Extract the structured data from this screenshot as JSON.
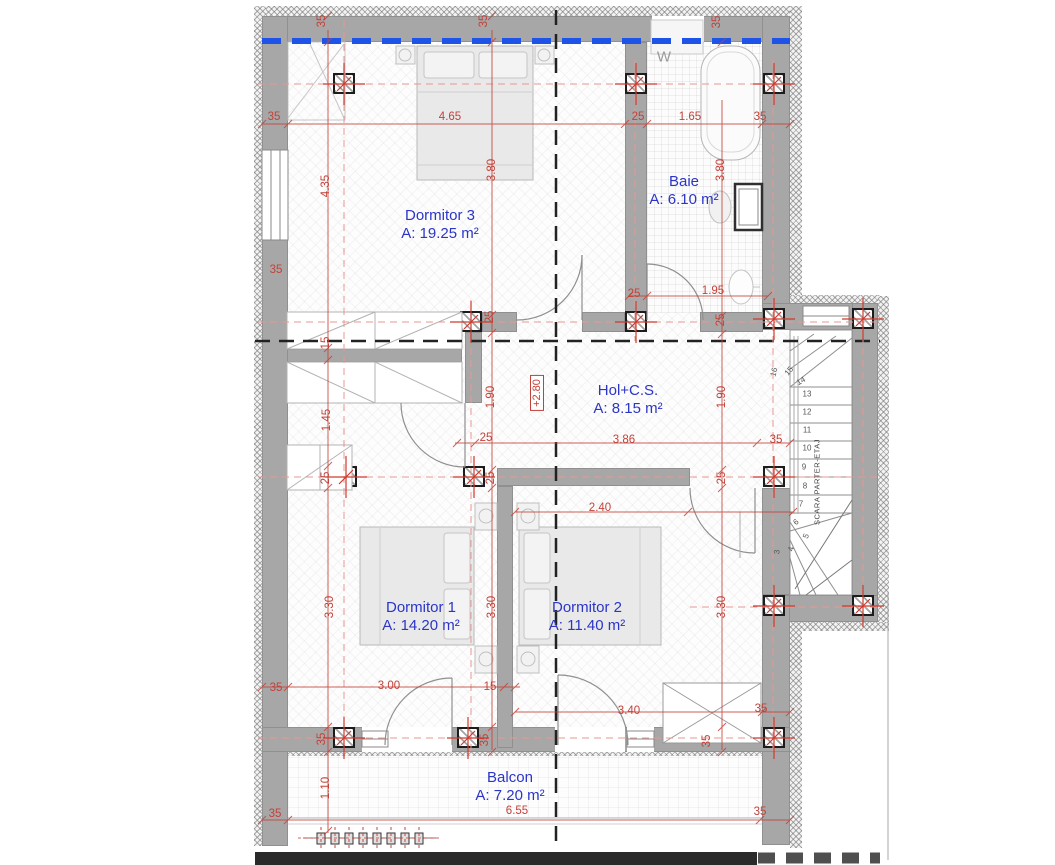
{
  "plan": {
    "type": "floor-plan",
    "colors": {
      "dimension_red": "#c2423a",
      "room_label_blue": "#2b35c8",
      "wall_gray": "#a7a7a7",
      "section_line_blue": "#1d53e6",
      "axis_pink": "#e59991"
    },
    "rooms": [
      {
        "id": "dormitor3",
        "name": "Dormitor 3",
        "area": "A: 19.25 m²",
        "x": 440,
        "y": 225
      },
      {
        "id": "baie",
        "name": "Baie",
        "area": "A: 6.10 m²",
        "x": 684,
        "y": 191
      },
      {
        "id": "hol",
        "name": "Hol+C.S.",
        "area": "A: 8.15 m²",
        "x": 628,
        "y": 400
      },
      {
        "id": "dormitor1",
        "name": "Dormitor 1",
        "area": "A: 14.20 m²",
        "x": 421,
        "y": 617
      },
      {
        "id": "dormitor2",
        "name": "Dormitor 2",
        "area": "A: 11.40 m²",
        "x": 587,
        "y": 617
      },
      {
        "id": "balcon",
        "name": "Balcon",
        "area": "A: 7.20 m²",
        "x": 510,
        "y": 787
      }
    ],
    "labels": {
      "washer": "W",
      "level_marker": "+2.80",
      "stairs": "SCARA PARTER-ETAJ"
    },
    "dimensions": [
      {
        "t": "35",
        "x": 322,
        "y": 21,
        "r": -90
      },
      {
        "t": "35",
        "x": 484,
        "y": 21,
        "r": -90
      },
      {
        "t": "35",
        "x": 717,
        "y": 22,
        "r": -90
      },
      {
        "t": "35",
        "x": 274,
        "y": 117,
        "r": 0
      },
      {
        "t": "4.65",
        "x": 450,
        "y": 117,
        "r": 0
      },
      {
        "t": "25",
        "x": 638,
        "y": 117,
        "r": 0
      },
      {
        "t": "1.65",
        "x": 690,
        "y": 117,
        "r": 0
      },
      {
        "t": "35",
        "x": 760,
        "y": 117,
        "r": 0
      },
      {
        "t": "4.35",
        "x": 326,
        "y": 186,
        "r": -90
      },
      {
        "t": "3.80",
        "x": 492,
        "y": 170,
        "r": -90
      },
      {
        "t": "3.80",
        "x": 721,
        "y": 170,
        "r": -90
      },
      {
        "t": "35",
        "x": 276,
        "y": 270,
        "r": 0
      },
      {
        "t": "25",
        "x": 490,
        "y": 317,
        "r": -90
      },
      {
        "t": "25",
        "x": 721,
        "y": 320,
        "r": -90
      },
      {
        "t": "25",
        "x": 634,
        "y": 294,
        "r": 0
      },
      {
        "t": "1.95",
        "x": 713,
        "y": 291,
        "r": 0
      },
      {
        "t": "15",
        "x": 326,
        "y": 343,
        "r": -90
      },
      {
        "t": "1.90",
        "x": 491,
        "y": 397,
        "r": -90
      },
      {
        "t": "1.90",
        "x": 722,
        "y": 397,
        "r": -90
      },
      {
        "t": "1.45",
        "x": 327,
        "y": 420,
        "r": -90
      },
      {
        "t": "25",
        "x": 486,
        "y": 438,
        "r": 0
      },
      {
        "t": "3.86",
        "x": 624,
        "y": 440,
        "r": 0
      },
      {
        "t": "35",
        "x": 776,
        "y": 440,
        "r": 0
      },
      {
        "t": "25",
        "x": 326,
        "y": 478,
        "r": -90
      },
      {
        "t": "25",
        "x": 491,
        "y": 478,
        "r": -90
      },
      {
        "t": "25",
        "x": 722,
        "y": 478,
        "r": -90
      },
      {
        "t": "2.40",
        "x": 600,
        "y": 508,
        "r": 0
      },
      {
        "t": "3.30",
        "x": 330,
        "y": 607,
        "r": -90
      },
      {
        "t": "3.30",
        "x": 492,
        "y": 607,
        "r": -90
      },
      {
        "t": "3.30",
        "x": 722,
        "y": 607,
        "r": -90
      },
      {
        "t": "35",
        "x": 276,
        "y": 688,
        "r": 0
      },
      {
        "t": "3.00",
        "x": 389,
        "y": 686,
        "r": 0
      },
      {
        "t": "15",
        "x": 490,
        "y": 687,
        "r": 0
      },
      {
        "t": "3.40",
        "x": 629,
        "y": 711,
        "r": 0
      },
      {
        "t": "35",
        "x": 761,
        "y": 709,
        "r": 0
      },
      {
        "t": "35",
        "x": 322,
        "y": 739,
        "r": -90
      },
      {
        "t": "35",
        "x": 485,
        "y": 740,
        "r": -90
      },
      {
        "t": "35",
        "x": 707,
        "y": 741,
        "r": -90
      },
      {
        "t": "1.10",
        "x": 326,
        "y": 788,
        "r": -90
      },
      {
        "t": "35",
        "x": 275,
        "y": 814,
        "r": 0
      },
      {
        "t": "6.55",
        "x": 517,
        "y": 811,
        "r": 0
      },
      {
        "t": "35",
        "x": 760,
        "y": 812,
        "r": 0
      }
    ],
    "stair_steps": [
      {
        "t": "16",
        "x": 774,
        "y": 372,
        "r": -75
      },
      {
        "t": "15",
        "x": 789,
        "y": 371,
        "r": -50
      },
      {
        "t": "14",
        "x": 801,
        "y": 381,
        "r": -30
      },
      {
        "t": "13",
        "x": 807,
        "y": 394,
        "r": 0
      },
      {
        "t": "12",
        "x": 807,
        "y": 412,
        "r": 0
      },
      {
        "t": "11",
        "x": 807,
        "y": 430,
        "r": 0
      },
      {
        "t": "10",
        "x": 807,
        "y": 448,
        "r": 0
      },
      {
        "t": "9",
        "x": 804,
        "y": 467,
        "r": 0
      },
      {
        "t": "8",
        "x": 805,
        "y": 486,
        "r": 0
      },
      {
        "t": "7",
        "x": 801,
        "y": 504,
        "r": 0
      },
      {
        "t": "6",
        "x": 796,
        "y": 522,
        "r": -40
      },
      {
        "t": "5",
        "x": 806,
        "y": 536,
        "r": -65
      },
      {
        "t": "4",
        "x": 791,
        "y": 549,
        "r": -80
      },
      {
        "t": "3",
        "x": 777,
        "y": 552,
        "r": -85
      }
    ]
  }
}
